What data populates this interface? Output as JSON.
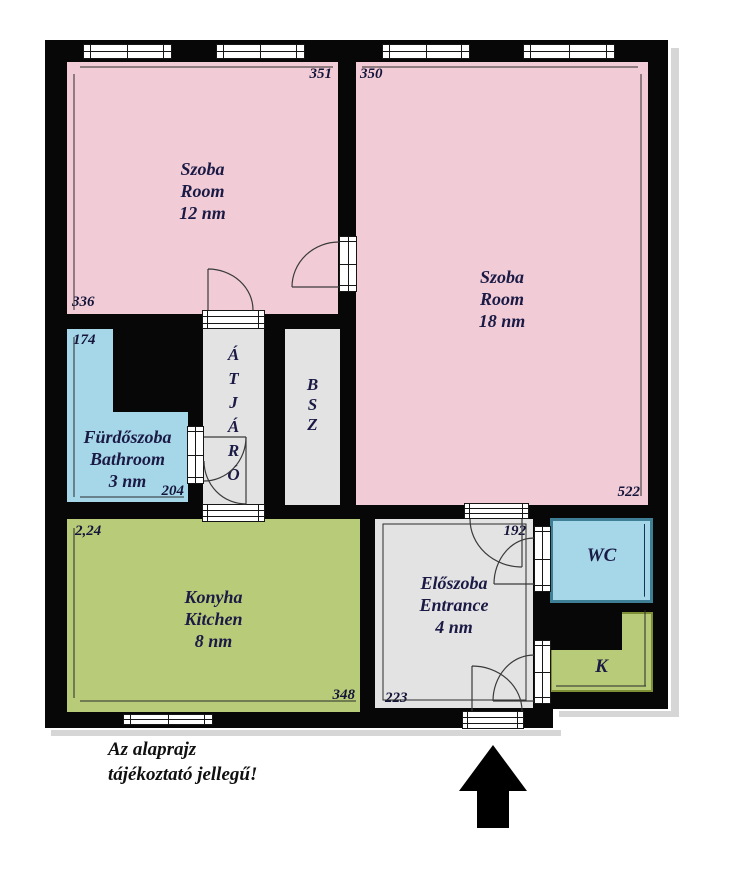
{
  "palette": {
    "room_pink": "#f1ccd7",
    "wet_blue": "#a6d7e9",
    "kitchen_green": "#b7cb79",
    "hall_gray": "#e3e3e3",
    "wall_black": "#070707",
    "label_navy": "#1a1a45",
    "wc_border_blue": "#3e7f96",
    "pantry_border_green": "#7f8f35"
  },
  "rooms": {
    "room12": {
      "name_hu": "Szoba",
      "name_en": "Room",
      "area": "12 nm",
      "dim_top": "351",
      "dim_bottom": "336"
    },
    "room18": {
      "name_hu": "Szoba",
      "name_en": "Room",
      "area": "18 nm",
      "dim_top": "350",
      "dim_bottom": "522"
    },
    "bathroom": {
      "name_hu": "Fürdőszoba",
      "name_en": "Bathroom",
      "area": "3 nm",
      "dim_top": "174",
      "dim_bottom": "204"
    },
    "passage": {
      "label": "ÁTJÁRÓ",
      "letters": [
        "Á",
        "T",
        "J",
        "Á",
        "R",
        "Ó"
      ]
    },
    "bsz": {
      "label": "BSZ",
      "letters": [
        "B",
        "S",
        "Z"
      ]
    },
    "kitchen": {
      "name_hu": "Konyha",
      "name_en": "Kitchen",
      "area": "8 nm",
      "dim_top": "2,24",
      "dim_bottom": "348"
    },
    "entrance": {
      "name_hu": "Előszoba",
      "name_en": "Entrance",
      "area": "4 nm",
      "dim_top": "192",
      "dim_bottom": "223"
    },
    "wc": {
      "label": "WC"
    },
    "pantry": {
      "label": "K"
    }
  },
  "note": {
    "line1": "Az alaprajz",
    "line2": "tájékoztató jellegű!"
  },
  "compass": {
    "icon": "north-arrow"
  }
}
